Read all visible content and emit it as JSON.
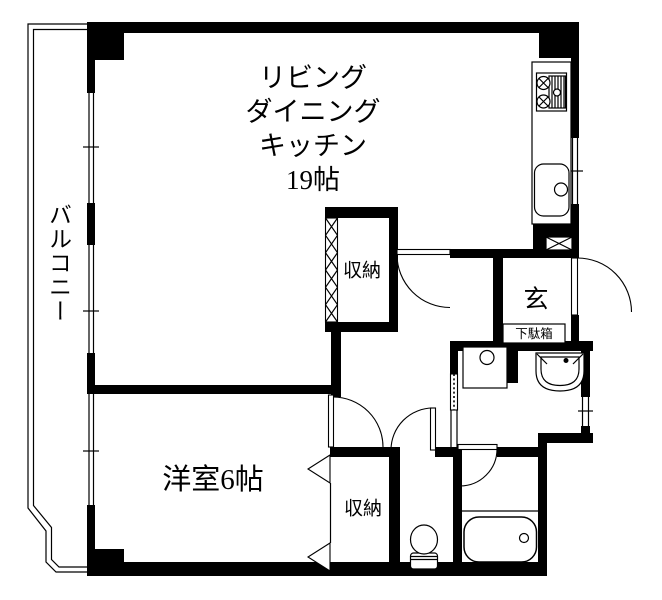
{
  "floor_plan": {
    "background": "#ffffff",
    "wall_color": "#000000",
    "line_color": "#000000",
    "rooms": {
      "ldk": {
        "label_lines": [
          "リビング",
          "ダイニング",
          "キッチン",
          "19帖"
        ]
      },
      "balcony": {
        "label": "バルコニー"
      },
      "western_room": {
        "label": "洋室6帖"
      },
      "closet_upper": {
        "label": "収納"
      },
      "closet_lower": {
        "label": "収納"
      },
      "entrance": {
        "label": "玄"
      },
      "shoe_cabinet": {
        "label": "下駄箱"
      }
    }
  }
}
